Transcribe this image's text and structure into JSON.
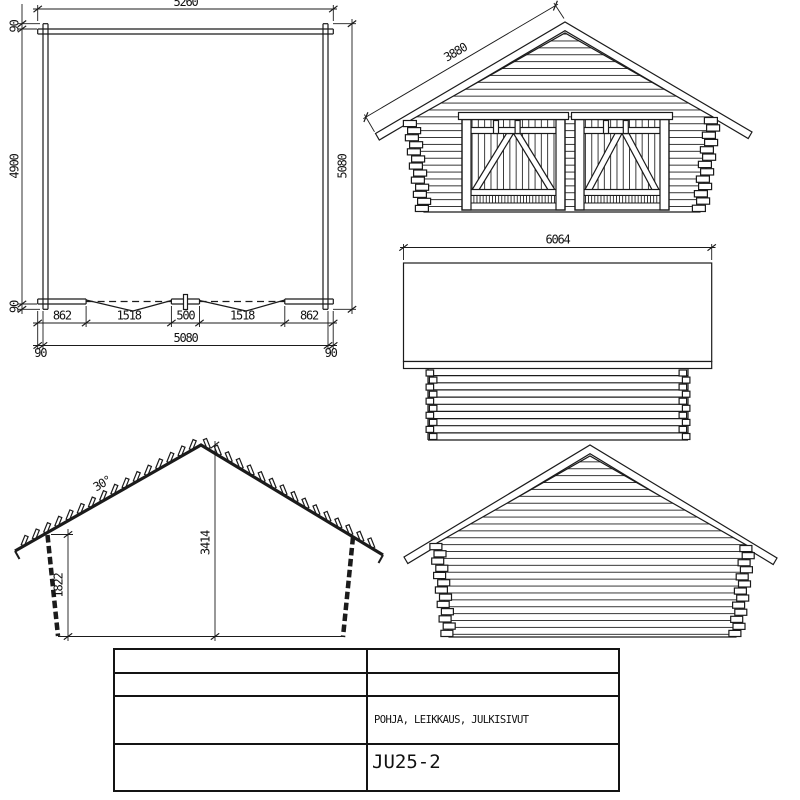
{
  "sheet": {
    "background": "#ffffff",
    "line_color": "#1b1b1b"
  },
  "floor_plan": {
    "dim_top_total": "5260",
    "dim_left_end_top": "90",
    "dim_left_inner": "4900",
    "dim_left_end_bottom": "90",
    "dim_right_total": "5080",
    "dim_bottom_segments": [
      "862",
      "1518",
      "500",
      "1518",
      "862"
    ],
    "dim_bottom_total": "5080",
    "dim_bottom_end_left": "90",
    "dim_bottom_end_right": "90"
  },
  "front_elevation": {
    "dim_roof_slope": "3880"
  },
  "roof_side_view": {
    "dim_roof_length": "6064"
  },
  "cross_section": {
    "roof_pitch": "30°",
    "ridge_height": "3414",
    "eave_height": "1822"
  },
  "title_block": {
    "drawing_title": "POHJA, LEIKKAUS, JULKISIVUT",
    "model_code": "JU25-2"
  }
}
